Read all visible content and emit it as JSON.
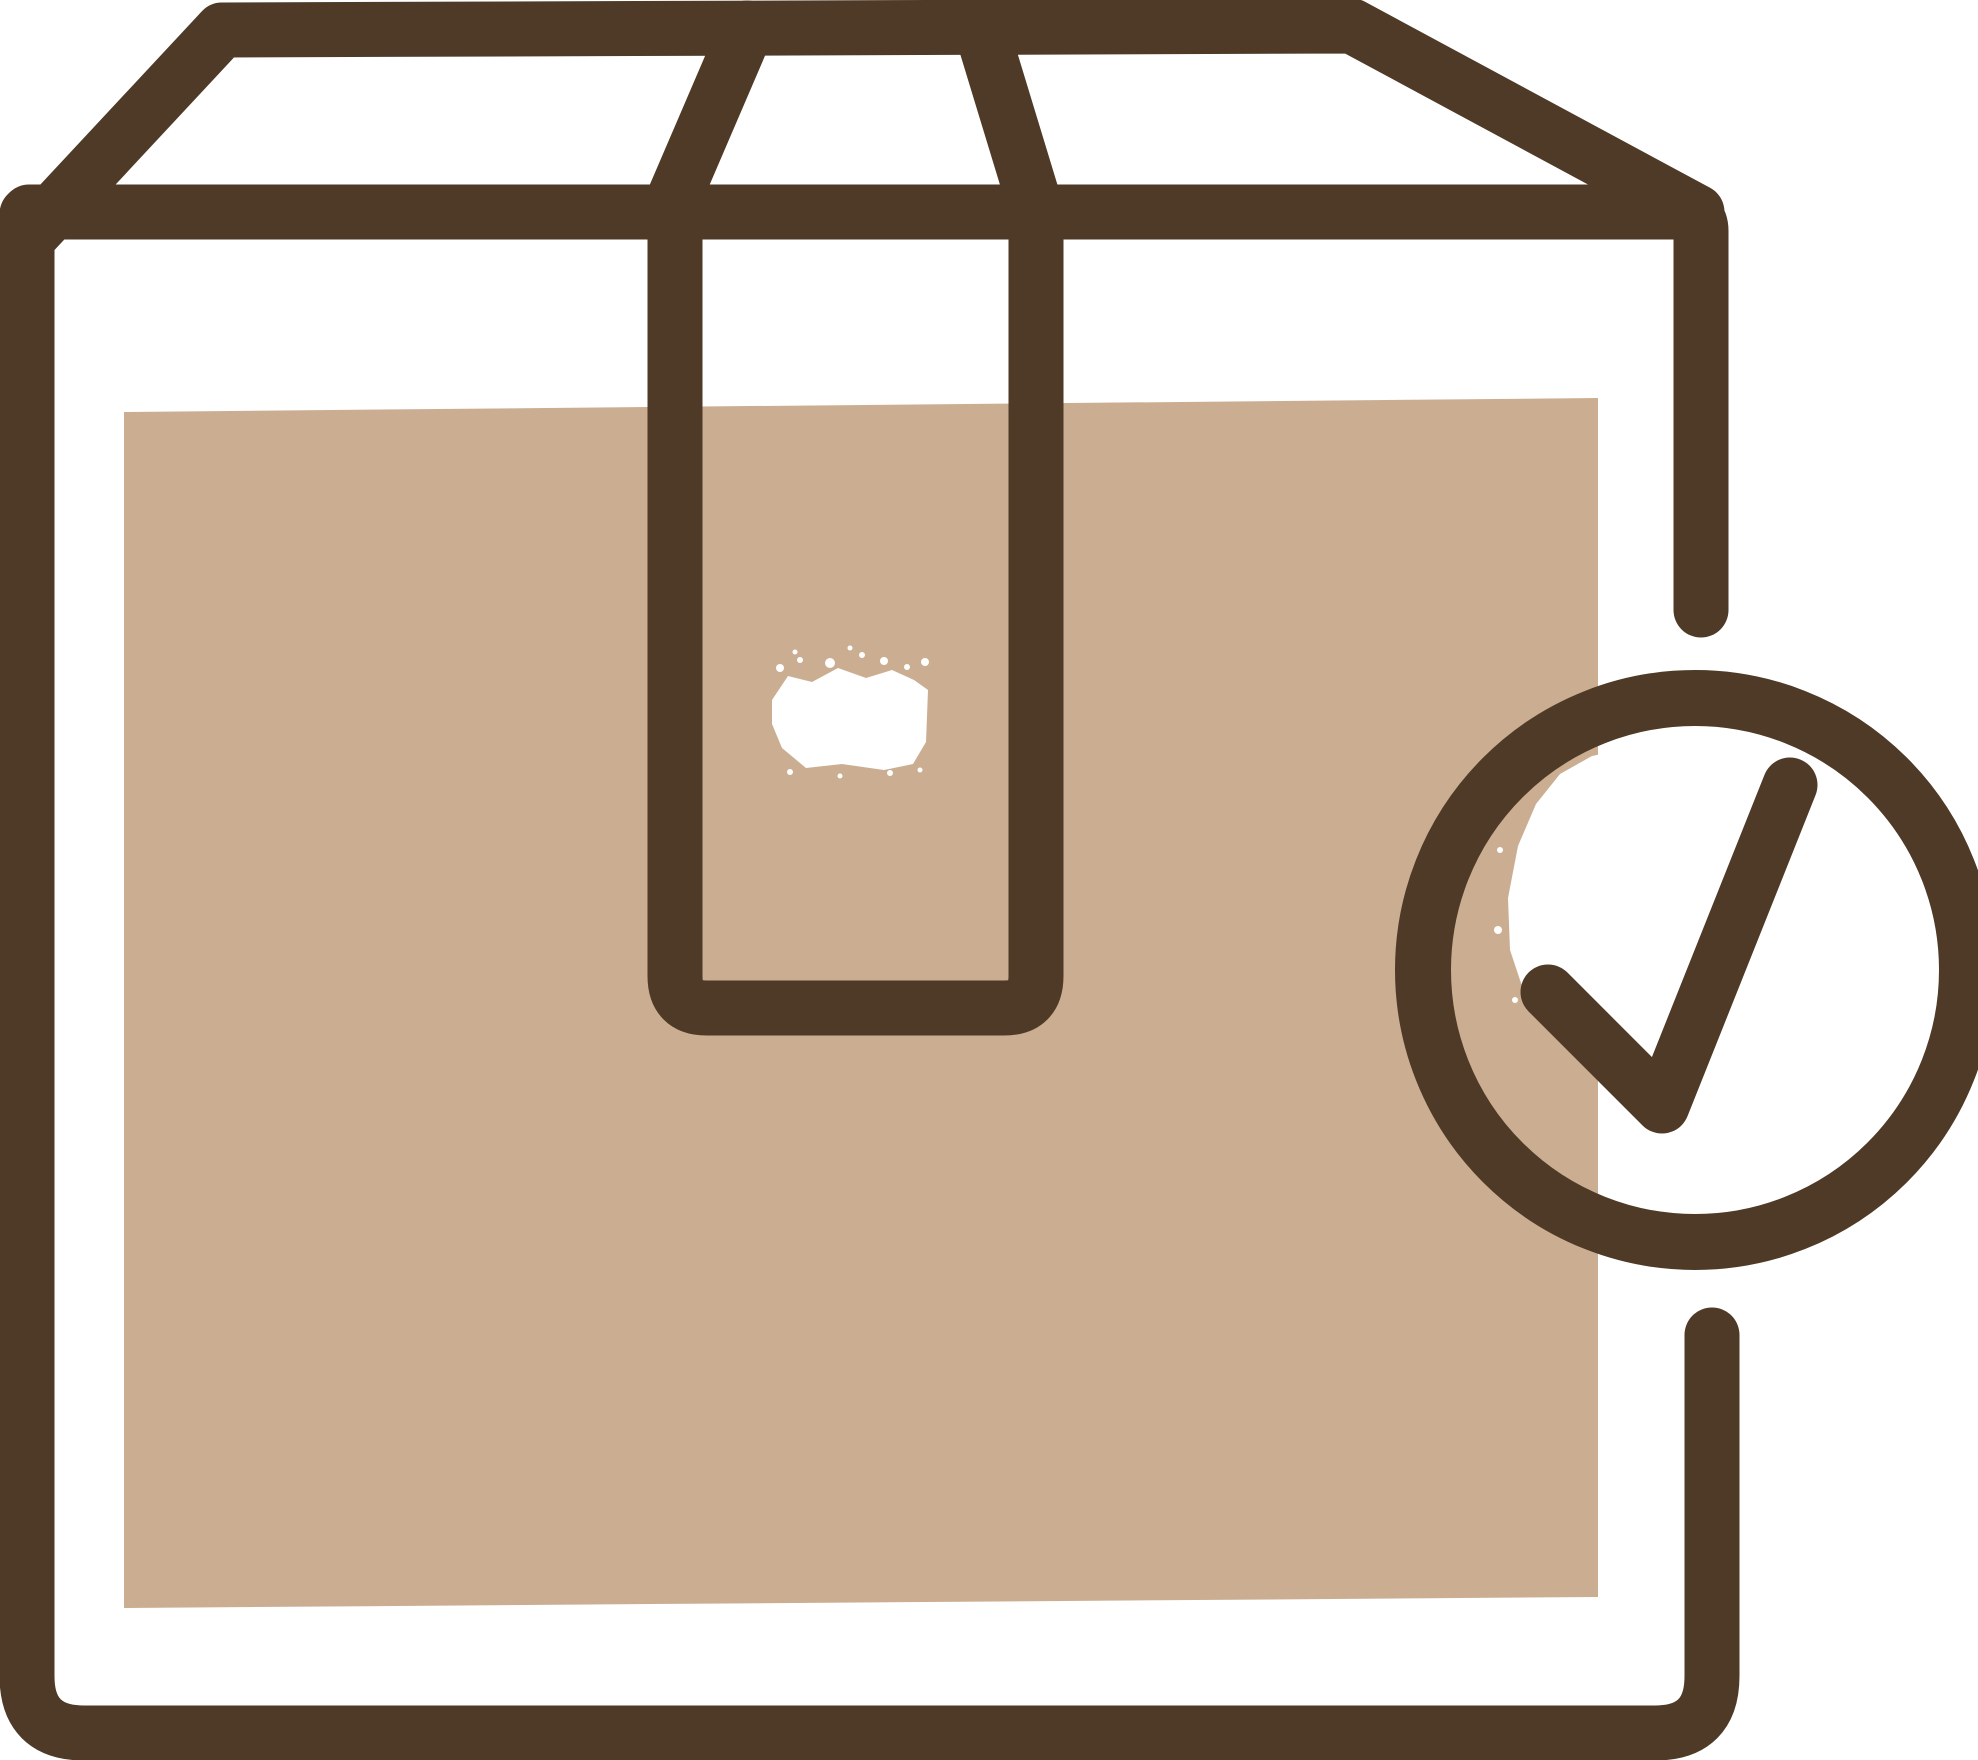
{
  "icon": {
    "name": "package-delivered-icon",
    "description": "Hand-drawn style icon of a sealed cardboard shipping box with packing tape and a circled check mark badge indicating confirmed delivery",
    "canvas": {
      "width": 1978,
      "height": 1760
    },
    "colors": {
      "outline": "#4e3a26",
      "box_fill": "#cbae92",
      "background": "#ffffff",
      "highlight": "#ffffff"
    },
    "parts": [
      "box-lid",
      "box-front",
      "packing-tape",
      "tape-highlight",
      "check-circle",
      "check-mark"
    ]
  }
}
